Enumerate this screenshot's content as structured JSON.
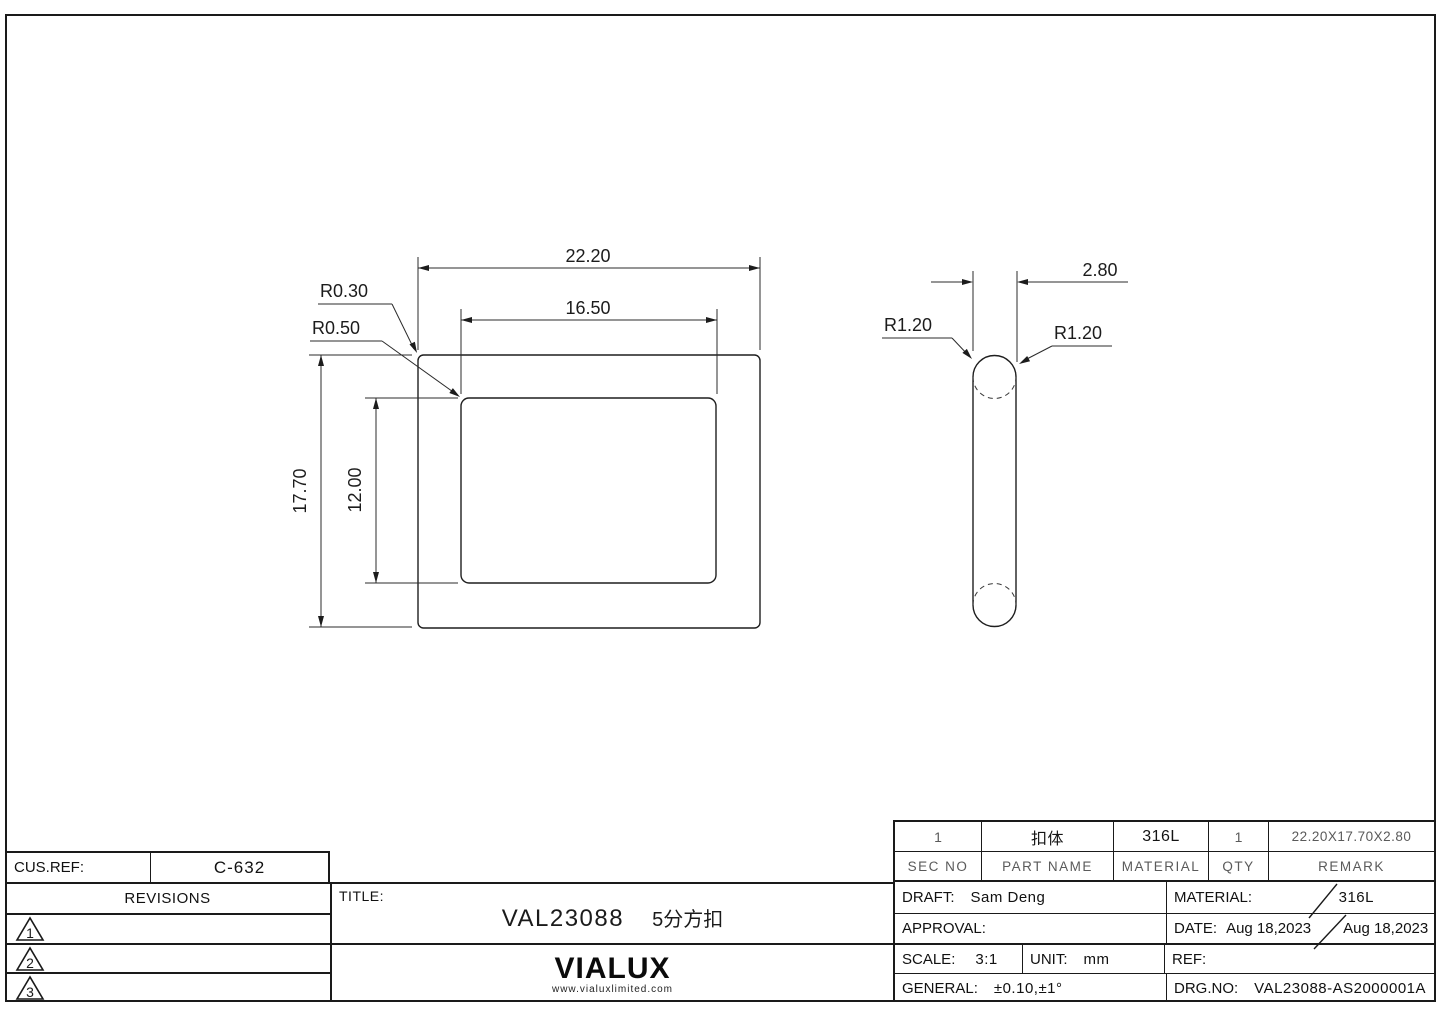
{
  "drawing": {
    "front_view": {
      "width_outer": "22.20",
      "width_inner": "16.50",
      "height_outer": "17.70",
      "height_inner": "12.00",
      "radius_outer_label": "R0.30",
      "radius_inner_label": "R0.50"
    },
    "side_view": {
      "thickness": "2.80",
      "radius_left_label": "R1.20",
      "radius_right_label": "R1.20"
    }
  },
  "parts_table": {
    "headers": {
      "sec_no": "SEC NO",
      "part_name": "PART NAME",
      "material": "MATERIAL",
      "qty": "QTY",
      "remark": "REMARK"
    },
    "row": {
      "sec_no": "1",
      "part_name": "扣体",
      "material": "316L",
      "qty": "1",
      "remark": "22.20X17.70X2.80"
    }
  },
  "title_block": {
    "cus_ref_label": "CUS.REF:",
    "cus_ref_value": "C-632",
    "revisions_label": "REVISIONS",
    "revisions": [
      "1",
      "2",
      "3"
    ],
    "title_label": "TITLE:",
    "title_value": "VAL23088",
    "title_value_cn": "5分方扣",
    "logo_text": "VIALUX",
    "logo_site": "www.vialuxlimited.com",
    "draft_label": "DRAFT:",
    "draft_value": "Sam Deng",
    "approval_label": "APPROVAL:",
    "material_label": "MATERIAL:",
    "material_value": "316L",
    "date_label": "DATE:",
    "date_value_1": "Aug 18,2023",
    "date_value_2": "Aug 18,2023",
    "scale_label": "SCALE:",
    "scale_value": "3:1",
    "unit_label": "UNIT:",
    "unit_value": "mm",
    "ref_label": "REF:",
    "general_label": "GENERAL:",
    "general_value": "±0.10,±1°",
    "drg_no_label": "DRG.NO:",
    "drg_no_value": "VAL23088-AS2000001A"
  }
}
